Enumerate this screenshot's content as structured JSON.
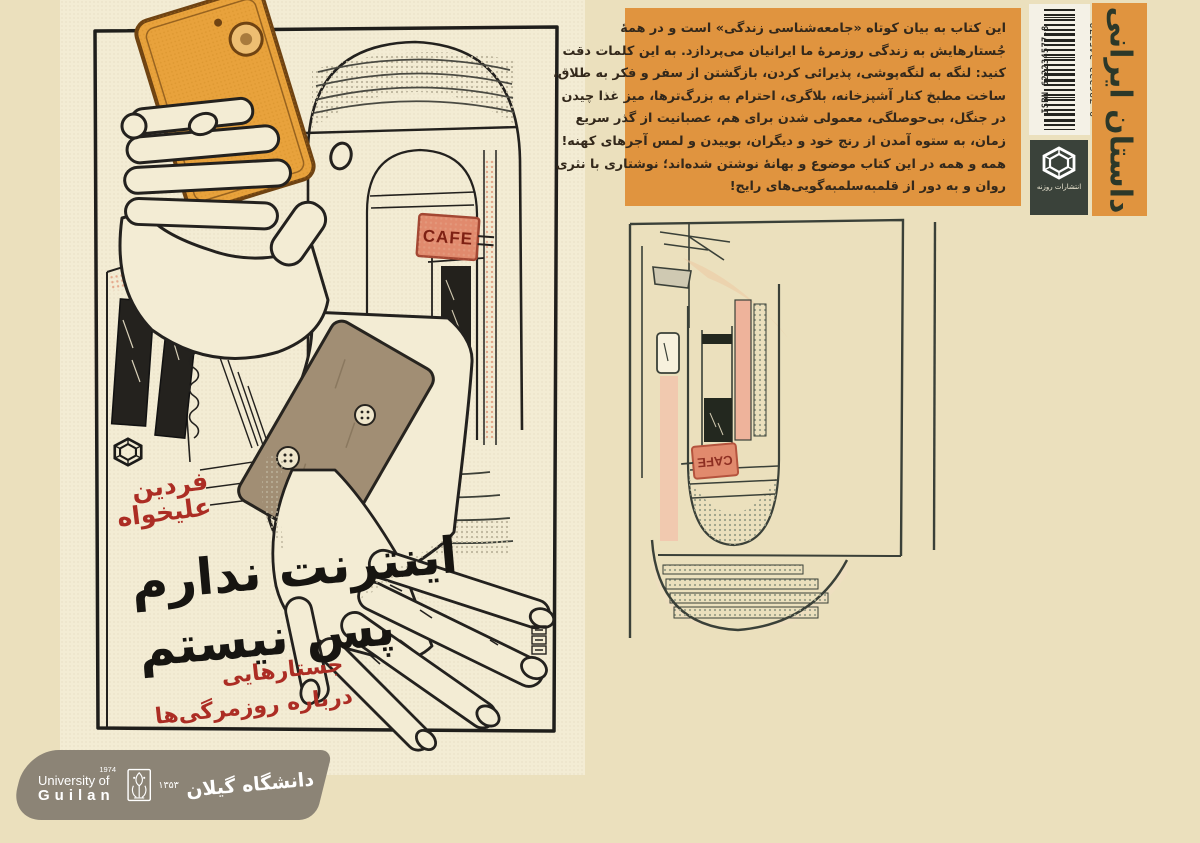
{
  "front": {
    "author_line1": "فردین",
    "author_line2": "علیخواه",
    "title_line1": "اینترنت ندارم",
    "title_line2": "پس نیستم",
    "subtitle_line1": "جستارهایی",
    "subtitle_line2": "درباره روزمرگی‌ها",
    "cafe_sign": "CAFE"
  },
  "back": {
    "blurb_lines": [
      "این کتاب به بیان کوتاه «جامعه‌شناسی زندگی» است و در همهٔ",
      "جُستارهایش به زندگی روزمرهٔ ما ایرانیان می‌پردازد. به این کلمات دقت",
      "کنید: لنگه به لنگه‌پوشی، پذیرائی کردن، بازگشتن از سفر و فکر به طلاق،",
      "ساخت مطبخ کنار آشپزخانه، بلاگری، احترام به بزرگ‌ترها، میز غذا چیدن",
      "در جنگل، بی‌حوصلگی، معمولی شدن برای هم، عصبانیت از گذر سریع",
      "زمان، به ستوه آمدن از رنج خود و دیگران، بوییدن و لمس آجرهای کهنه!",
      "همه و همه در این کتاب موضوع و بهانهٔ نوشتن شده‌اند؛ نوشتاری با نثری",
      "روان و به دور از قلمبه‌سلمبه‌گویی‌های رایج!"
    ],
    "cafe_sign": "CAFE",
    "isbn_label": "ISBN 622234577-8",
    "barcode_number": "9 786222 345778",
    "publisher_name": "انتشارات روزنه",
    "category_label": "داستان ایرانی"
  },
  "watermark": {
    "year_en": "1974",
    "uni_line1": "University of",
    "uni_line2": "Guilan",
    "year_fa": "۱۳۵۳",
    "uni_name_fa": "دانشگاه گیلان"
  },
  "colors": {
    "page_bg": "#ebe0bd",
    "cover_paper": "#f3ecd4",
    "accent_orange": "#e0943f",
    "title_red": "#ac2d24",
    "sign_salmon": "#e18a6d",
    "publisher_green": "#3a423a",
    "banner_gray": "#8c8476"
  }
}
